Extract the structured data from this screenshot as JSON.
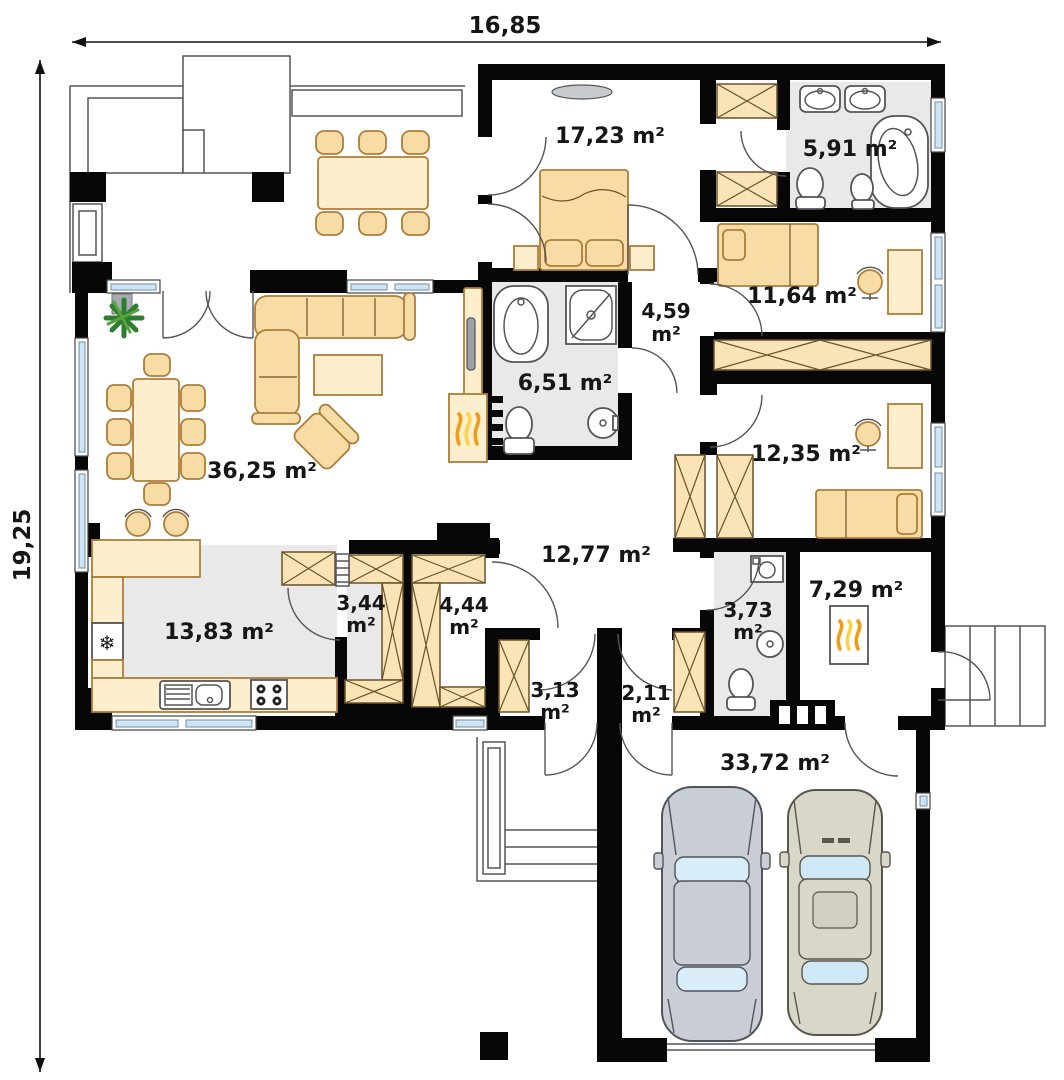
{
  "plan": {
    "type": "floor-plan",
    "unit": "m²",
    "dimensions": {
      "width": "16,85",
      "height": "19,25"
    },
    "rooms": [
      {
        "id": "bedroom-1",
        "area": "17,23",
        "label": "17,23 m²"
      },
      {
        "id": "bathroom-ensuite",
        "area": "5,91",
        "label": "5,91 m²"
      },
      {
        "id": "bedroom-2",
        "area": "11,64",
        "label": "11,64 m²"
      },
      {
        "id": "hall-bedrooms",
        "area": "4,59",
        "label": "4,59 m²"
      },
      {
        "id": "bathroom-main",
        "area": "6,51",
        "label": "6,51 m²"
      },
      {
        "id": "living-room",
        "area": "36,25",
        "label": "36,25 m²"
      },
      {
        "id": "bedroom-3",
        "area": "12,35",
        "label": "12,35 m²"
      },
      {
        "id": "hall-central",
        "area": "12,77",
        "label": "12,77 m²"
      },
      {
        "id": "kitchen",
        "area": "13,83",
        "label": "13,83 m²"
      },
      {
        "id": "pantry",
        "area": "3,44",
        "label": "3,44 m²"
      },
      {
        "id": "closet-room",
        "area": "4,44",
        "label": "4,44 m²"
      },
      {
        "id": "vestibule",
        "area": "3,13",
        "label": "3,13 m²"
      },
      {
        "id": "entry",
        "area": "2,11",
        "label": "2,11 m²"
      },
      {
        "id": "utility-wc",
        "area": "3,73",
        "label": "3,73 m²"
      },
      {
        "id": "boiler-room",
        "area": "7,29",
        "label": "7,29 m²"
      },
      {
        "id": "garage",
        "area": "33,72",
        "label": "33,72 m²"
      }
    ],
    "icons": {
      "fridge_glyph": "❄"
    },
    "colors": {
      "wall": "#070707",
      "furniture_fill": "#f8dca6",
      "furniture_stroke": "#ad7d3a",
      "floor_grey": "#e9e9e9",
      "window_glass": "#cfe4f5",
      "flame_orange": "#ef9d16",
      "plant_green": "#2f7d2f",
      "car_blue_grey": "#c9ced6",
      "car_beige": "#d9d6ca"
    }
  }
}
